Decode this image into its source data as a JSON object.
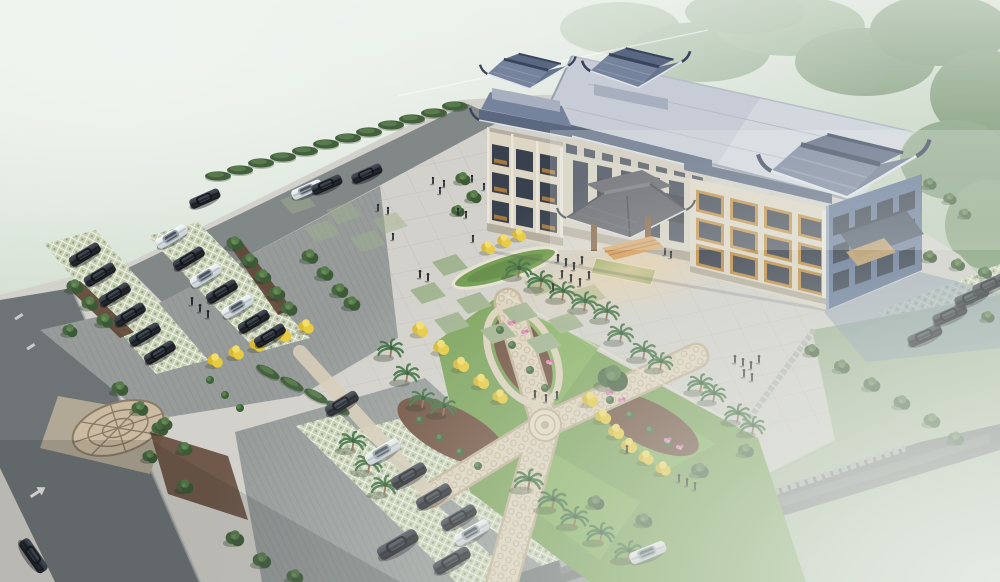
{
  "scene": {
    "title": "Aerial rendering of a Chinese-style civic building with forecourt plaza, landscaped gardens and parking lots in morning haze",
    "view": "bird's-eye perspective from the southwest",
    "atmosphere": "pale green mist over surrounding fields and forest",
    "building": {
      "floors": "3-4",
      "style": "traditional Chinese blue-gray tiled roofs with upturned eaves",
      "rooftop_pavilions": 2,
      "wings": [
        "left wing",
        "central hall with porte-cochere entrance canopy",
        "right wing with shaded side elevation and rear canopy"
      ],
      "facade": "cream stone, dark glazing, orange timber lattice window frames"
    },
    "landscape": {
      "plaza": "large light granite forecourt with tile grid, checkered bands and lawn insets",
      "garden": "diagonal crossing ornamental paths with central medallion, triangular lawns, mulch flower beds",
      "planting": [
        "palm trees",
        "golden ginkgo trees",
        "dark green trees and shrubs",
        "hedge rows",
        "pink flower clusters",
        "red-brown mulch beds"
      ],
      "parking": [
        "west lot on grass-grid pavers",
        "south lot on grass-grid pavers",
        "east strip beside building"
      ],
      "roads": [
        "west perimeter road with white turn arrow",
        "southeast access road with stone edge"
      ],
      "southeast": "open lawn dissolving into fog"
    },
    "vehicles": {
      "dark_sedans": 25,
      "white_sedans": 7,
      "suv": 1
    },
    "people_visible": 38,
    "sky_feature": "faint jet contrail upper middle"
  },
  "palette": {
    "sky_top": "#e9efe9",
    "sky_green": "#a9bfa2",
    "forest": "#6d8d66",
    "plaza": "#d3d1cb",
    "plaza_grid": "#b5b3ae",
    "road": "#6e7375",
    "road_top": "#828788",
    "parking": "#979c9b",
    "lattice": "#c6cfb4",
    "lawn_mist": "#c9d3c3",
    "garden_green": "#79a257",
    "lawn_bright": "#86b15f",
    "path": "#e0d5bf",
    "path_edge": "#c2b196",
    "mulch": "#6b4a38",
    "roof_light": "#c7ccd6",
    "roof_mid": "#76839c",
    "roof_dark": "#4a566e",
    "facade": "#ddd6c5",
    "facade_shade": "#5f7294",
    "window": "#39414e",
    "accent_orange": "#c08a3e",
    "canopy": "#54555c",
    "wood": "#7a5636",
    "steps": "#d8a05e",
    "car_dark": "#1a1d22",
    "car_white": "#edeff1",
    "tree_green": "#3f5e39",
    "palm_green": "#3f7040",
    "golden": "#e6c33c",
    "flower_pink": "#d884ae",
    "shadow_blue": "#7e92ab",
    "mist": "#e4e9e2"
  }
}
